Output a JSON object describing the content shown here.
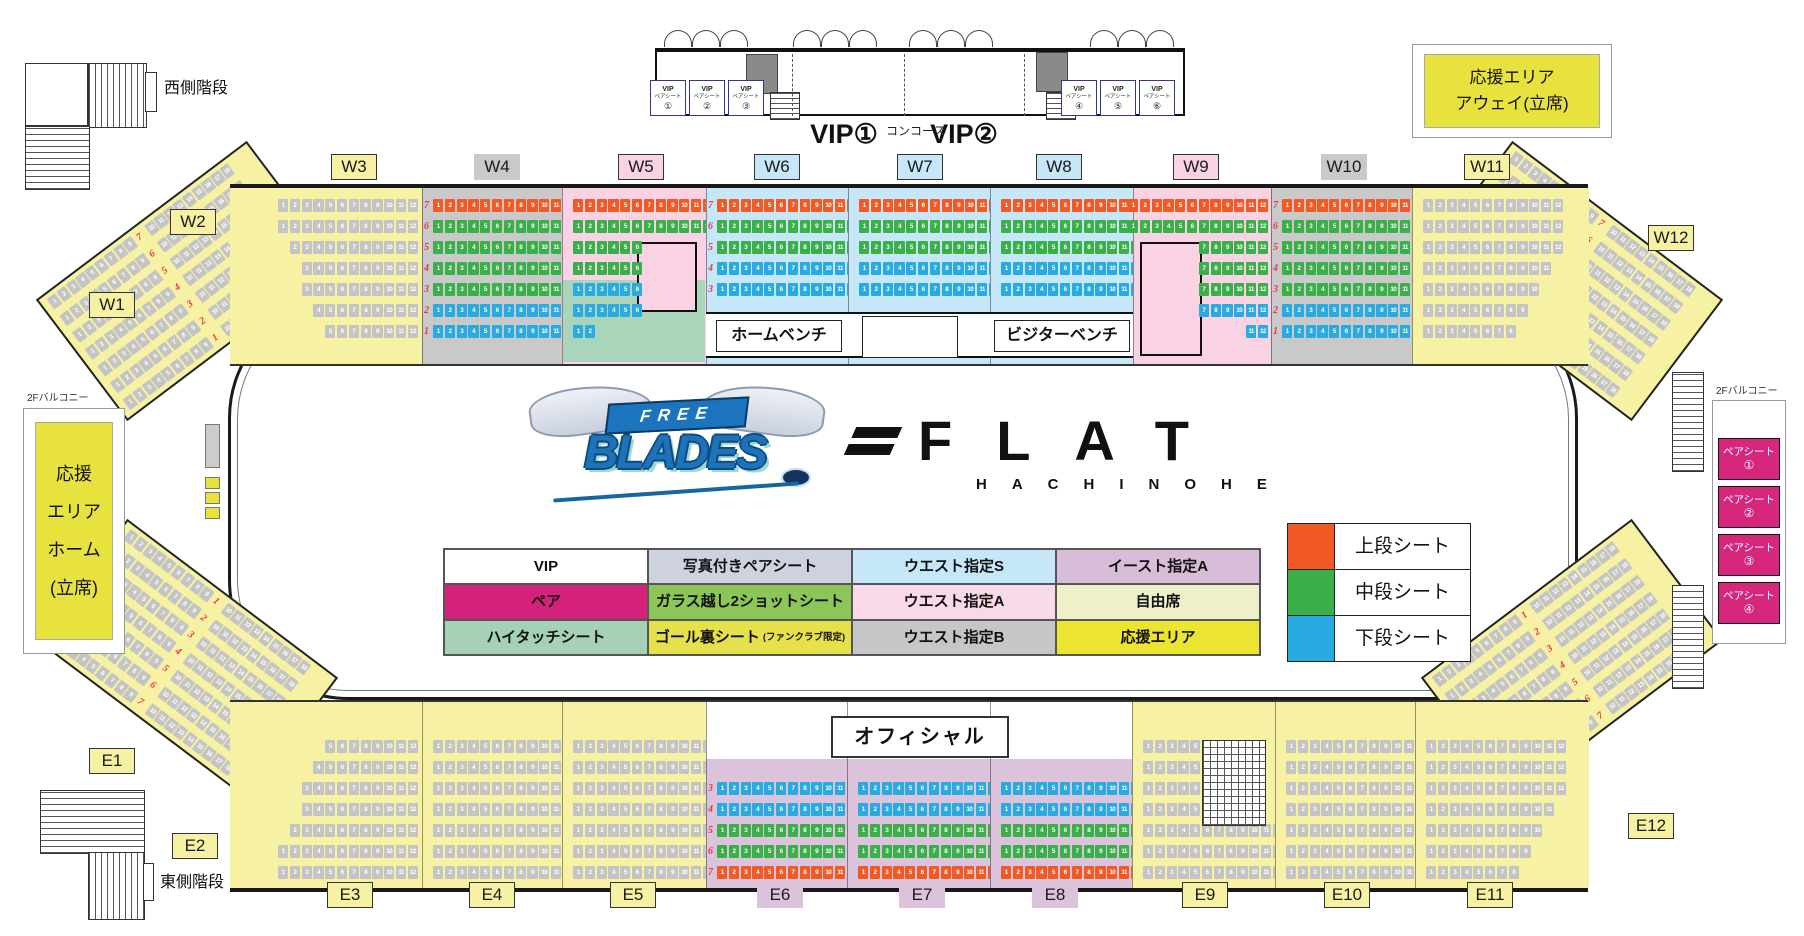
{
  "arena": {
    "west_stairs": "西側階段",
    "east_stairs": "東側階段",
    "concourse": "コンコース",
    "balcony_left": "2Fバルコニー",
    "balcony_right": "2Fバルコニー",
    "vip_rooms": [
      "VIP①",
      "VIP②"
    ],
    "vip_pair_line1": "VIP",
    "vip_pair_line2": "ペアシート",
    "vip_pair_nums": [
      "①",
      "②",
      "③",
      "④",
      "⑤",
      "⑥"
    ],
    "away_box": [
      "応援エリア",
      "アウェイ(立席)"
    ],
    "home_box": [
      "応援",
      "エリア",
      "ホーム",
      "(立席)"
    ],
    "pair_seat_label": "ペアシート",
    "pair_seat_nums": [
      "①",
      "②",
      "③",
      "④"
    ],
    "home_bench": "ホームベンチ",
    "visitor_bench": "ビジターベンチ",
    "official": "オフィシャル"
  },
  "logos": {
    "free": "FREE",
    "blades": "BLADES",
    "flat": "FLAT",
    "hachinohe": "HACHINOHE"
  },
  "legend_table": {
    "rows": [
      [
        {
          "label": "VIP",
          "bg": "#ffffff"
        },
        {
          "label": "写真付きペアシート",
          "bg": "#cdd2de"
        },
        {
          "label": "ウエスト指定S",
          "bg": "#c6e7f8"
        },
        {
          "label": "イースト指定A",
          "bg": "#d8bdd8"
        }
      ],
      [
        {
          "label": "ペア",
          "bg": "#d6217c"
        },
        {
          "label": "ガラス越し2ショットシート",
          "bg": "#8cc658"
        },
        {
          "label": "ウエスト指定A",
          "bg": "#f9d9e8"
        },
        {
          "label": "自由席",
          "bg": "#eef0ca"
        }
      ],
      [
        {
          "label": "ハイタッチシート",
          "bg": "#a5d2b6"
        },
        {
          "label": "ゴール裏シート",
          "note": "(ファンクラブ限定)",
          "bg": "#e6e04b"
        },
        {
          "label": "ウエスト指定B",
          "bg": "#c6c6c8"
        },
        {
          "label": "応援エリア",
          "bg": "#ebe532"
        }
      ]
    ]
  },
  "tier_legend": [
    {
      "label": "上段シート",
      "color": "#f15a24"
    },
    {
      "label": "中段シート",
      "color": "#3bb04a"
    },
    {
      "label": "下段シート",
      "color": "#29abe2"
    }
  ],
  "seat_palette": {
    "u": "#f15a24",
    "m": "#3bb04a",
    "l": "#29abe2",
    "g": "#c4c4c4"
  },
  "section_labels": {
    "west": [
      {
        "id": "W3",
        "bg": "#f7f1a3",
        "border": true
      },
      {
        "id": "W4",
        "bg": "#c9c9c9",
        "border": false
      },
      {
        "id": "W5",
        "bg": "#f9d3e3",
        "border": true
      },
      {
        "id": "W6",
        "bg": "#c6e7f8",
        "border": true
      },
      {
        "id": "W7",
        "bg": "#c6e7f8",
        "border": true
      },
      {
        "id": "W8",
        "bg": "#c6e7f8",
        "border": true
      },
      {
        "id": "W9",
        "bg": "#f9d3e3",
        "border": true
      },
      {
        "id": "W10",
        "bg": "#c9c9c9",
        "border": false
      },
      {
        "id": "W11",
        "bg": "#f7f1a3",
        "border": true
      }
    ],
    "east": [
      {
        "id": "E3",
        "bg": "#f7f1a3",
        "border": true
      },
      {
        "id": "E4",
        "bg": "#f7f1a3",
        "border": true
      },
      {
        "id": "E5",
        "bg": "#f7f1a3",
        "border": true
      },
      {
        "id": "E6",
        "bg": "#dbc3dc",
        "border": false
      },
      {
        "id": "E7",
        "bg": "#dbc3dc",
        "border": false
      },
      {
        "id": "E8",
        "bg": "#dbc3dc",
        "border": false
      },
      {
        "id": "E9",
        "bg": "#f7f1a3",
        "border": true
      },
      {
        "id": "E10",
        "bg": "#f7f1a3",
        "border": true
      },
      {
        "id": "E11",
        "bg": "#f7f1a3",
        "border": true
      }
    ],
    "corners": [
      {
        "id": "W1",
        "bg": "#f7f1a3",
        "border": true
      },
      {
        "id": "W2",
        "bg": "#f7f1a3",
        "border": true
      },
      {
        "id": "W12",
        "bg": "#f7f1a3",
        "border": true
      },
      {
        "id": "E1",
        "bg": "#f7f1a3",
        "border": true
      },
      {
        "id": "E2",
        "bg": "#f7f1a3",
        "border": true
      },
      {
        "id": "E12",
        "bg": "#f7f1a3",
        "border": true
      }
    ]
  },
  "corner_nums_north": [
    "7",
    "6",
    "5",
    "4",
    "3",
    "2",
    "1"
  ],
  "corner_nums_south": [
    "1",
    "2",
    "3",
    "4",
    "5",
    "6",
    "7"
  ],
  "stands": {
    "west": [
      {
        "id": "W3",
        "align": "right",
        "rows": [
          {
            "t": "g",
            "s": 1,
            "e": 12
          },
          {
            "t": "g",
            "s": 1,
            "e": 12
          },
          {
            "t": "g",
            "s": 2,
            "e": 12
          },
          {
            "t": "g",
            "s": 3,
            "e": 12
          },
          {
            "t": "g",
            "s": 3,
            "e": 12
          },
          {
            "t": "g",
            "s": 4,
            "e": 12
          },
          {
            "t": "g",
            "s": 5,
            "e": 12
          }
        ]
      },
      {
        "id": "W4",
        "numSide": "left",
        "nums": [
          "7",
          "6",
          "5",
          "4",
          "3",
          "2",
          "1"
        ],
        "rows": [
          {
            "t": "u",
            "s": 1,
            "e": 12
          },
          {
            "t": "m",
            "s": 1,
            "e": 12
          },
          {
            "t": "m",
            "s": 1,
            "e": 12
          },
          {
            "t": "m",
            "s": 1,
            "e": 12
          },
          {
            "t": "m",
            "s": 1,
            "e": 12
          },
          {
            "t": "l",
            "s": 1,
            "e": 12
          },
          {
            "t": "l",
            "s": 1,
            "e": 12
          }
        ]
      },
      {
        "id": "W5",
        "align": "left",
        "rows": [
          {
            "t": "u",
            "s": 1,
            "e": 12
          },
          {
            "t": "m",
            "s": 1,
            "e": 12
          },
          {
            "t": "m",
            "s": 1,
            "e": 6
          },
          {
            "t": "m",
            "s": 1,
            "e": 6
          },
          {
            "t": "l",
            "s": 1,
            "e": 6
          },
          {
            "t": "l",
            "s": 1,
            "e": 6
          },
          {
            "t": "l",
            "s": 1,
            "e": 2
          }
        ]
      },
      {
        "id": "W6",
        "numSide": "left",
        "nums": [
          "7",
          "6",
          "5",
          "4",
          "3"
        ],
        "rows": [
          {
            "t": "u",
            "s": 1,
            "e": 12
          },
          {
            "t": "m",
            "s": 1,
            "e": 12
          },
          {
            "t": "m",
            "s": 1,
            "e": 12
          },
          {
            "t": "l",
            "s": 1,
            "e": 12
          },
          {
            "t": "l",
            "s": 1,
            "e": 12
          }
        ]
      },
      {
        "id": "W7",
        "rows": [
          {
            "t": "u",
            "s": 1,
            "e": 12
          },
          {
            "t": "m",
            "s": 1,
            "e": 12
          },
          {
            "t": "m",
            "s": 1,
            "e": 12
          },
          {
            "t": "l",
            "s": 1,
            "e": 12
          },
          {
            "t": "l",
            "s": 1,
            "e": 12
          }
        ]
      },
      {
        "id": "W8",
        "rows": [
          {
            "t": "u",
            "s": 1,
            "e": 12
          },
          {
            "t": "m",
            "s": 1,
            "e": 12
          },
          {
            "t": "m",
            "s": 1,
            "e": 12
          },
          {
            "t": "l",
            "s": 1,
            "e": 12
          },
          {
            "t": "l",
            "s": 1,
            "e": 12
          }
        ]
      },
      {
        "id": "W9",
        "align": "right",
        "rows": [
          {
            "t": "u",
            "s": 1,
            "e": 12
          },
          {
            "t": "m",
            "s": 1,
            "e": 12
          },
          {
            "t": "m",
            "s": 7,
            "e": 12
          },
          {
            "t": "m",
            "s": 7,
            "e": 12
          },
          {
            "t": "m",
            "s": 7,
            "e": 12
          },
          {
            "t": "l",
            "s": 7,
            "e": 12
          },
          {
            "t": "l",
            "s": 11,
            "e": 12
          }
        ]
      },
      {
        "id": "W10",
        "numSide": "left",
        "nums": [
          "7",
          "6",
          "5",
          "4",
          "3",
          "2",
          "1"
        ],
        "rows": [
          {
            "t": "u",
            "s": 1,
            "e": 12
          },
          {
            "t": "m",
            "s": 1,
            "e": 12
          },
          {
            "t": "m",
            "s": 1,
            "e": 12
          },
          {
            "t": "m",
            "s": 1,
            "e": 12
          },
          {
            "t": "m",
            "s": 1,
            "e": 12
          },
          {
            "t": "l",
            "s": 1,
            "e": 12
          },
          {
            "t": "l",
            "s": 1,
            "e": 12
          }
        ]
      },
      {
        "id": "W11",
        "align": "left",
        "rows": [
          {
            "t": "g",
            "s": 1,
            "e": 12
          },
          {
            "t": "g",
            "s": 1,
            "e": 12
          },
          {
            "t": "g",
            "s": 1,
            "e": 12
          },
          {
            "t": "g",
            "s": 1,
            "e": 11
          },
          {
            "t": "g",
            "s": 1,
            "e": 10
          },
          {
            "t": "g",
            "s": 1,
            "e": 9
          },
          {
            "t": "g",
            "s": 1,
            "e": 8
          }
        ]
      }
    ],
    "east": [
      {
        "id": "E3",
        "align": "right",
        "numSide": "right",
        "nums": [
          "1",
          "2",
          "3",
          "4",
          "5",
          "6",
          "7"
        ],
        "rows": [
          {
            "t": "g",
            "s": 5,
            "e": 12
          },
          {
            "t": "g",
            "s": 4,
            "e": 12
          },
          {
            "t": "g",
            "s": 3,
            "e": 12
          },
          {
            "t": "g",
            "s": 3,
            "e": 12
          },
          {
            "t": "g",
            "s": 2,
            "e": 12
          },
          {
            "t": "g",
            "s": 1,
            "e": 12
          },
          {
            "t": "g",
            "s": 1,
            "e": 12
          }
        ]
      },
      {
        "id": "E4",
        "rows": [
          {
            "t": "g",
            "s": 1,
            "e": 12
          },
          {
            "t": "g",
            "s": 1,
            "e": 12
          },
          {
            "t": "g",
            "s": 1,
            "e": 12
          },
          {
            "t": "g",
            "s": 1,
            "e": 12
          },
          {
            "t": "g",
            "s": 1,
            "e": 12
          },
          {
            "t": "g",
            "s": 1,
            "e": 12
          },
          {
            "t": "g",
            "s": 1,
            "e": 12
          }
        ]
      },
      {
        "id": "E5",
        "rows": [
          {
            "t": "g",
            "s": 1,
            "e": 12
          },
          {
            "t": "g",
            "s": 1,
            "e": 12
          },
          {
            "t": "g",
            "s": 1,
            "e": 12
          },
          {
            "t": "g",
            "s": 1,
            "e": 12
          },
          {
            "t": "g",
            "s": 1,
            "e": 12
          },
          {
            "t": "g",
            "s": 1,
            "e": 12
          },
          {
            "t": "g",
            "s": 1,
            "e": 12
          }
        ]
      },
      {
        "id": "E6",
        "numSide": "left",
        "nums": [
          "3",
          "4",
          "5",
          "6",
          "7"
        ],
        "rows": [
          {
            "t": "l",
            "s": 1,
            "e": 12
          },
          {
            "t": "l",
            "s": 1,
            "e": 12
          },
          {
            "t": "m",
            "s": 1,
            "e": 12
          },
          {
            "t": "m",
            "s": 1,
            "e": 12
          },
          {
            "t": "u",
            "s": 1,
            "e": 12
          }
        ]
      },
      {
        "id": "E7",
        "numSide": "right",
        "nums": [
          "3",
          "4",
          "5",
          "6",
          "7"
        ],
        "rows": [
          {
            "t": "l",
            "s": 1,
            "e": 12
          },
          {
            "t": "l",
            "s": 1,
            "e": 12
          },
          {
            "t": "m",
            "s": 1,
            "e": 12
          },
          {
            "t": "m",
            "s": 1,
            "e": 12
          },
          {
            "t": "u",
            "s": 1,
            "e": 12
          }
        ]
      },
      {
        "id": "E8",
        "rows": [
          {
            "t": "l",
            "s": 1,
            "e": 12
          },
          {
            "t": "l",
            "s": 1,
            "e": 12
          },
          {
            "t": "m",
            "s": 1,
            "e": 12
          },
          {
            "t": "m",
            "s": 1,
            "e": 12
          },
          {
            "t": "u",
            "s": 1,
            "e": 12
          }
        ]
      },
      {
        "id": "E9",
        "align": "left",
        "rows": [
          {
            "t": "g",
            "s": 1,
            "e": 5
          },
          {
            "t": "g",
            "s": 1,
            "e": 5
          },
          {
            "t": "g",
            "s": 1,
            "e": 5
          },
          {
            "t": "g",
            "s": 1,
            "e": 5
          },
          {
            "t": "g",
            "s": 1,
            "e": 12
          },
          {
            "t": "g",
            "s": 1,
            "e": 12
          },
          {
            "t": "g",
            "s": 1,
            "e": 12
          }
        ]
      },
      {
        "id": "E10",
        "rows": [
          {
            "t": "g",
            "s": 1,
            "e": 12
          },
          {
            "t": "g",
            "s": 1,
            "e": 12
          },
          {
            "t": "g",
            "s": 1,
            "e": 12
          },
          {
            "t": "g",
            "s": 1,
            "e": 12
          },
          {
            "t": "g",
            "s": 1,
            "e": 12
          },
          {
            "t": "g",
            "s": 1,
            "e": 12
          },
          {
            "t": "g",
            "s": 1,
            "e": 12
          }
        ]
      },
      {
        "id": "E11",
        "rows": [
          {
            "t": "g",
            "s": 1,
            "e": 12
          },
          {
            "t": "g",
            "s": 1,
            "e": 12
          },
          {
            "t": "g",
            "s": 1,
            "e": 12
          },
          {
            "t": "g",
            "s": 1,
            "e": 11
          },
          {
            "t": "g",
            "s": 1,
            "e": 10
          },
          {
            "t": "g",
            "s": 1,
            "e": 9
          },
          {
            "t": "g",
            "s": 1,
            "e": 8
          }
        ]
      }
    ]
  }
}
